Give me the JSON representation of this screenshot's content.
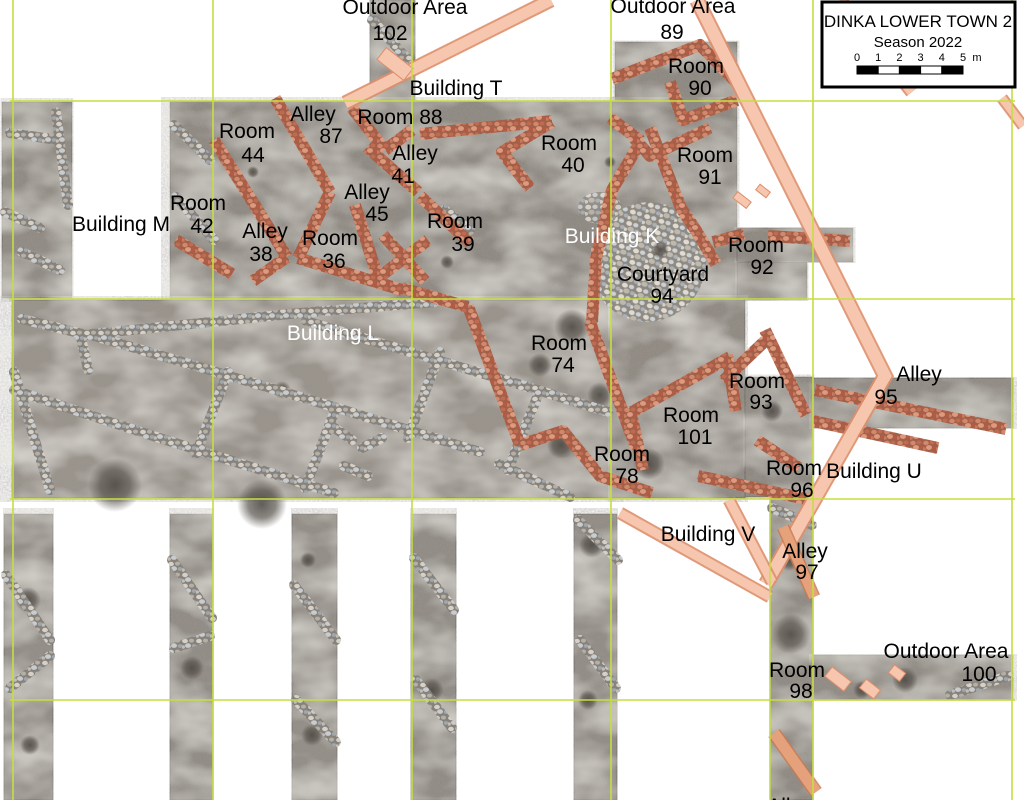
{
  "legend": {
    "title": "DINKA LOWER TOWN 2",
    "subtitle": "Season 2022",
    "scale_ticks": [
      "0",
      "1",
      "2",
      "3",
      "4",
      "5"
    ],
    "scale_unit": "m"
  },
  "colors": {
    "grid": "#c6de3f",
    "overlay_fill": "#f6c6ae",
    "overlay_edge": "#dd8f6b",
    "wall_terracotta": "#c4745a",
    "label_dark": "#000000",
    "label_light": "#ffffff"
  },
  "map": {
    "labels": [
      {
        "t": "Outdoor Area",
        "x": 405,
        "y": 14
      },
      {
        "t": "102",
        "x": 390,
        "y": 40
      },
      {
        "t": "Outdoor Area",
        "x": 673,
        "y": 13
      },
      {
        "t": "89",
        "x": 672,
        "y": 39
      },
      {
        "t": "Building T",
        "x": 456,
        "y": 95
      },
      {
        "t": "Room",
        "x": 696,
        "y": 73
      },
      {
        "t": "90",
        "x": 700,
        "y": 95
      },
      {
        "t": "Room",
        "x": 247,
        "y": 138
      },
      {
        "t": "44",
        "x": 253,
        "y": 162
      },
      {
        "t": "Alley",
        "x": 313,
        "y": 121
      },
      {
        "t": "87",
        "x": 331,
        "y": 143
      },
      {
        "t": "Room 88",
        "x": 400,
        "y": 124
      },
      {
        "t": "Alley",
        "x": 415,
        "y": 160
      },
      {
        "t": "41",
        "x": 403,
        "y": 183
      },
      {
        "t": "Room",
        "x": 198,
        "y": 210
      },
      {
        "t": "42",
        "x": 202,
        "y": 233
      },
      {
        "t": "Alley",
        "x": 265,
        "y": 238
      },
      {
        "t": "38",
        "x": 261,
        "y": 261
      },
      {
        "t": "Alley",
        "x": 367,
        "y": 199
      },
      {
        "t": "45",
        "x": 377,
        "y": 221
      },
      {
        "t": "Room",
        "x": 330,
        "y": 245
      },
      {
        "t": "36",
        "x": 334,
        "y": 268
      },
      {
        "t": "Room",
        "x": 455,
        "y": 228
      },
      {
        "t": "39",
        "x": 463,
        "y": 251
      },
      {
        "t": "Room",
        "x": 569,
        "y": 150
      },
      {
        "t": "40",
        "x": 573,
        "y": 172
      },
      {
        "t": "Room",
        "x": 705,
        "y": 162
      },
      {
        "t": "91",
        "x": 710,
        "y": 184
      },
      {
        "t": "Building K",
        "x": 612,
        "y": 243,
        "c": "#ffffff"
      },
      {
        "t": "Courtyard",
        "x": 663,
        "y": 281
      },
      {
        "t": "94",
        "x": 662,
        "y": 303
      },
      {
        "t": "Room",
        "x": 756,
        "y": 252
      },
      {
        "t": "92",
        "x": 762,
        "y": 274
      },
      {
        "t": "Building M",
        "x": 121,
        "y": 231
      },
      {
        "t": "Building L",
        "x": 333,
        "y": 340,
        "c": "#ffffff"
      },
      {
        "t": "Room",
        "x": 559,
        "y": 350
      },
      {
        "t": "74",
        "x": 563,
        "y": 372
      },
      {
        "t": "Room",
        "x": 757,
        "y": 388
      },
      {
        "t": "93",
        "x": 761,
        "y": 409
      },
      {
        "t": "Alley",
        "x": 919,
        "y": 381
      },
      {
        "t": "95",
        "x": 886,
        "y": 404
      },
      {
        "t": "Room",
        "x": 691,
        "y": 422
      },
      {
        "t": "101",
        "x": 695,
        "y": 444
      },
      {
        "t": "Room",
        "x": 622,
        "y": 461
      },
      {
        "t": "78",
        "x": 627,
        "y": 483
      },
      {
        "t": "Room",
        "x": 794,
        "y": 475
      },
      {
        "t": "96",
        "x": 802,
        "y": 497
      },
      {
        "t": "Building U",
        "x": 874,
        "y": 478
      },
      {
        "t": "Building V",
        "x": 708,
        "y": 541
      },
      {
        "t": "Alley",
        "x": 805,
        "y": 558
      },
      {
        "t": "97",
        "x": 807,
        "y": 579
      },
      {
        "t": "Room",
        "x": 797,
        "y": 677
      },
      {
        "t": "98",
        "x": 801,
        "y": 698
      },
      {
        "t": "Outdoor Area",
        "x": 946,
        "y": 658
      },
      {
        "t": "100",
        "x": 979,
        "y": 681
      },
      {
        "t": "Alley",
        "x": 790,
        "y": 813
      }
    ]
  }
}
